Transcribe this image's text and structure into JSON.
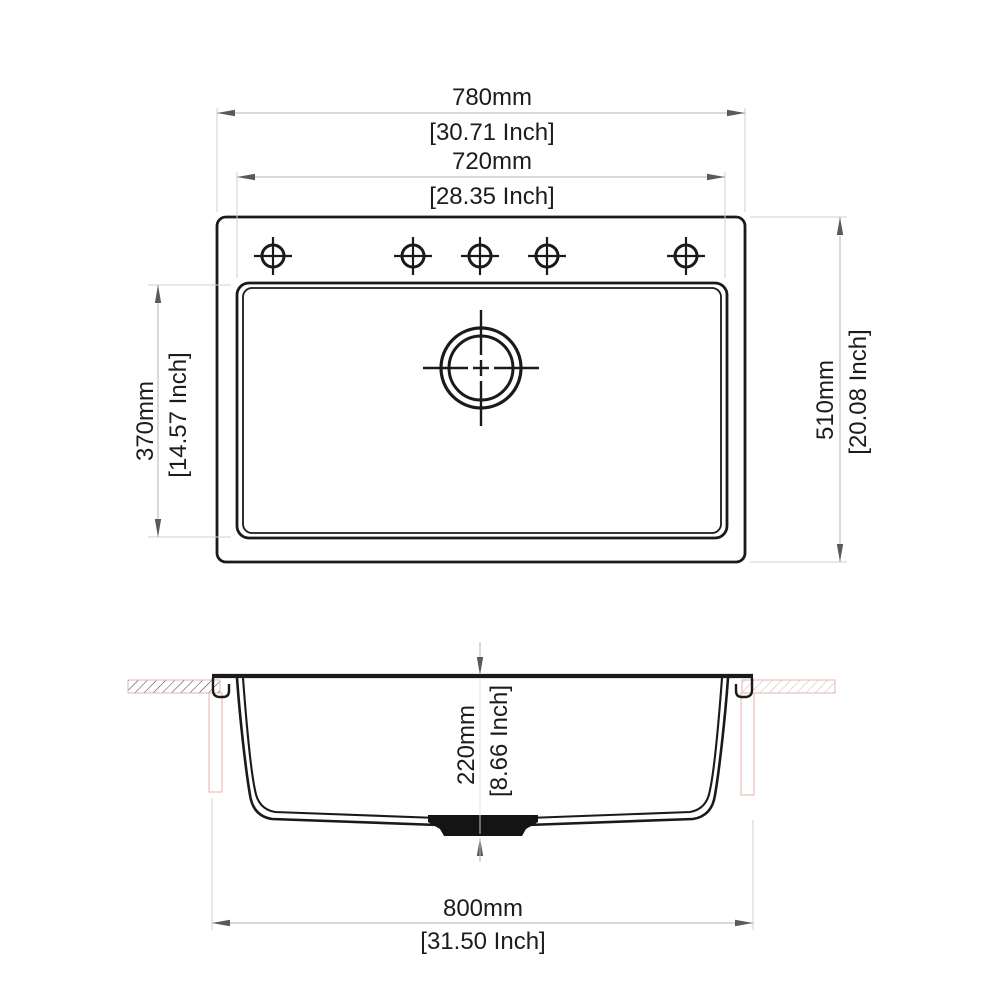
{
  "drawing_type": "kitchen sink technical dimension drawing",
  "palette": {
    "line_black": "#1a1a1a",
    "dim_line_gray": "#b5b5b5",
    "ext_line_gray": "#d2d2d2",
    "arrow_gray": "#5a5a5a",
    "countertop_pink": "#e5b6b2",
    "clamp_pink": "#eab2ac",
    "hatch_dark": "#3a3a3a",
    "hatch_pink": "#d9b2ae"
  },
  "top_view": {
    "faucet_hole_count": 5,
    "width_dim": {
      "mm": "780mm",
      "inch": "[30.71 Inch]"
    },
    "inner_width_dim": {
      "mm": "720mm",
      "inch": "[28.35 Inch]"
    },
    "inner_depth_dim": {
      "mm": "370mm",
      "inch": "[14.57 Inch]"
    },
    "outer_depth_dim": {
      "mm": "510mm",
      "inch": "[20.08 Inch]"
    }
  },
  "section_view": {
    "bowl_depth_dim": {
      "mm": "220mm",
      "inch": "[8.66 Inch]"
    },
    "overall_width_dim": {
      "mm": "800mm",
      "inch": "[31.50 Inch]"
    }
  }
}
